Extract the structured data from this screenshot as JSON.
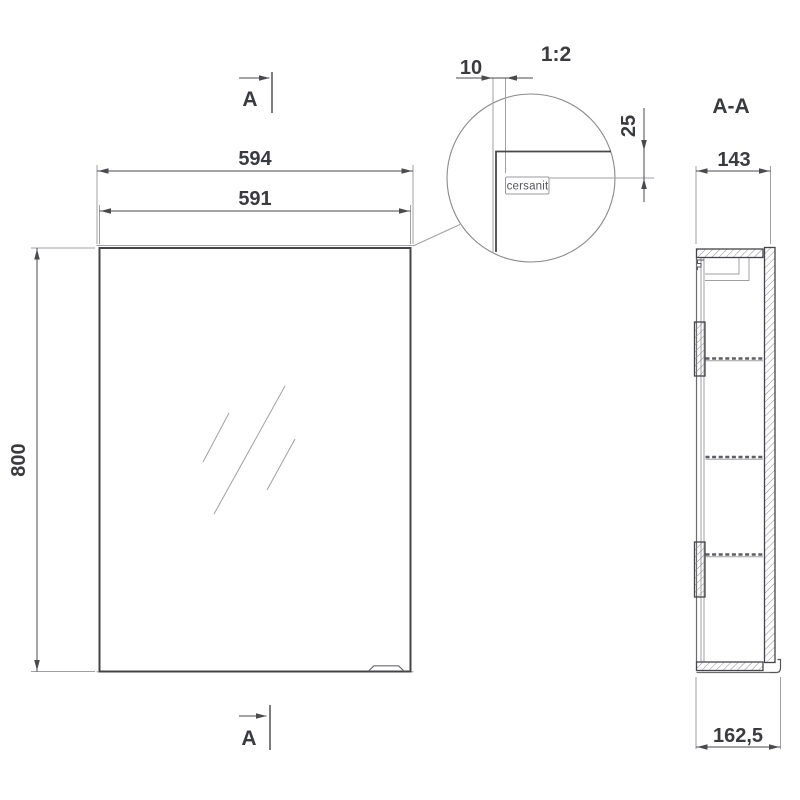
{
  "colors": {
    "background": "#ffffff",
    "line_dark": "#44444b",
    "line_dim": "#4a4a50",
    "line_light": "#a0a0a3",
    "text": "#3a3a41"
  },
  "front_view": {
    "dim_body_width": "594",
    "dim_door_width": "591",
    "dim_height": "800",
    "section_cut_top": "A",
    "section_cut_bottom": "A"
  },
  "detail_view": {
    "scale_label": "1:2",
    "dim_edge_gap": "10",
    "dim_logo_offset": "25",
    "logo_text": "cersanit"
  },
  "section_view": {
    "title": "A-A",
    "dim_depth": "143",
    "dim_total_depth": "162,5"
  }
}
